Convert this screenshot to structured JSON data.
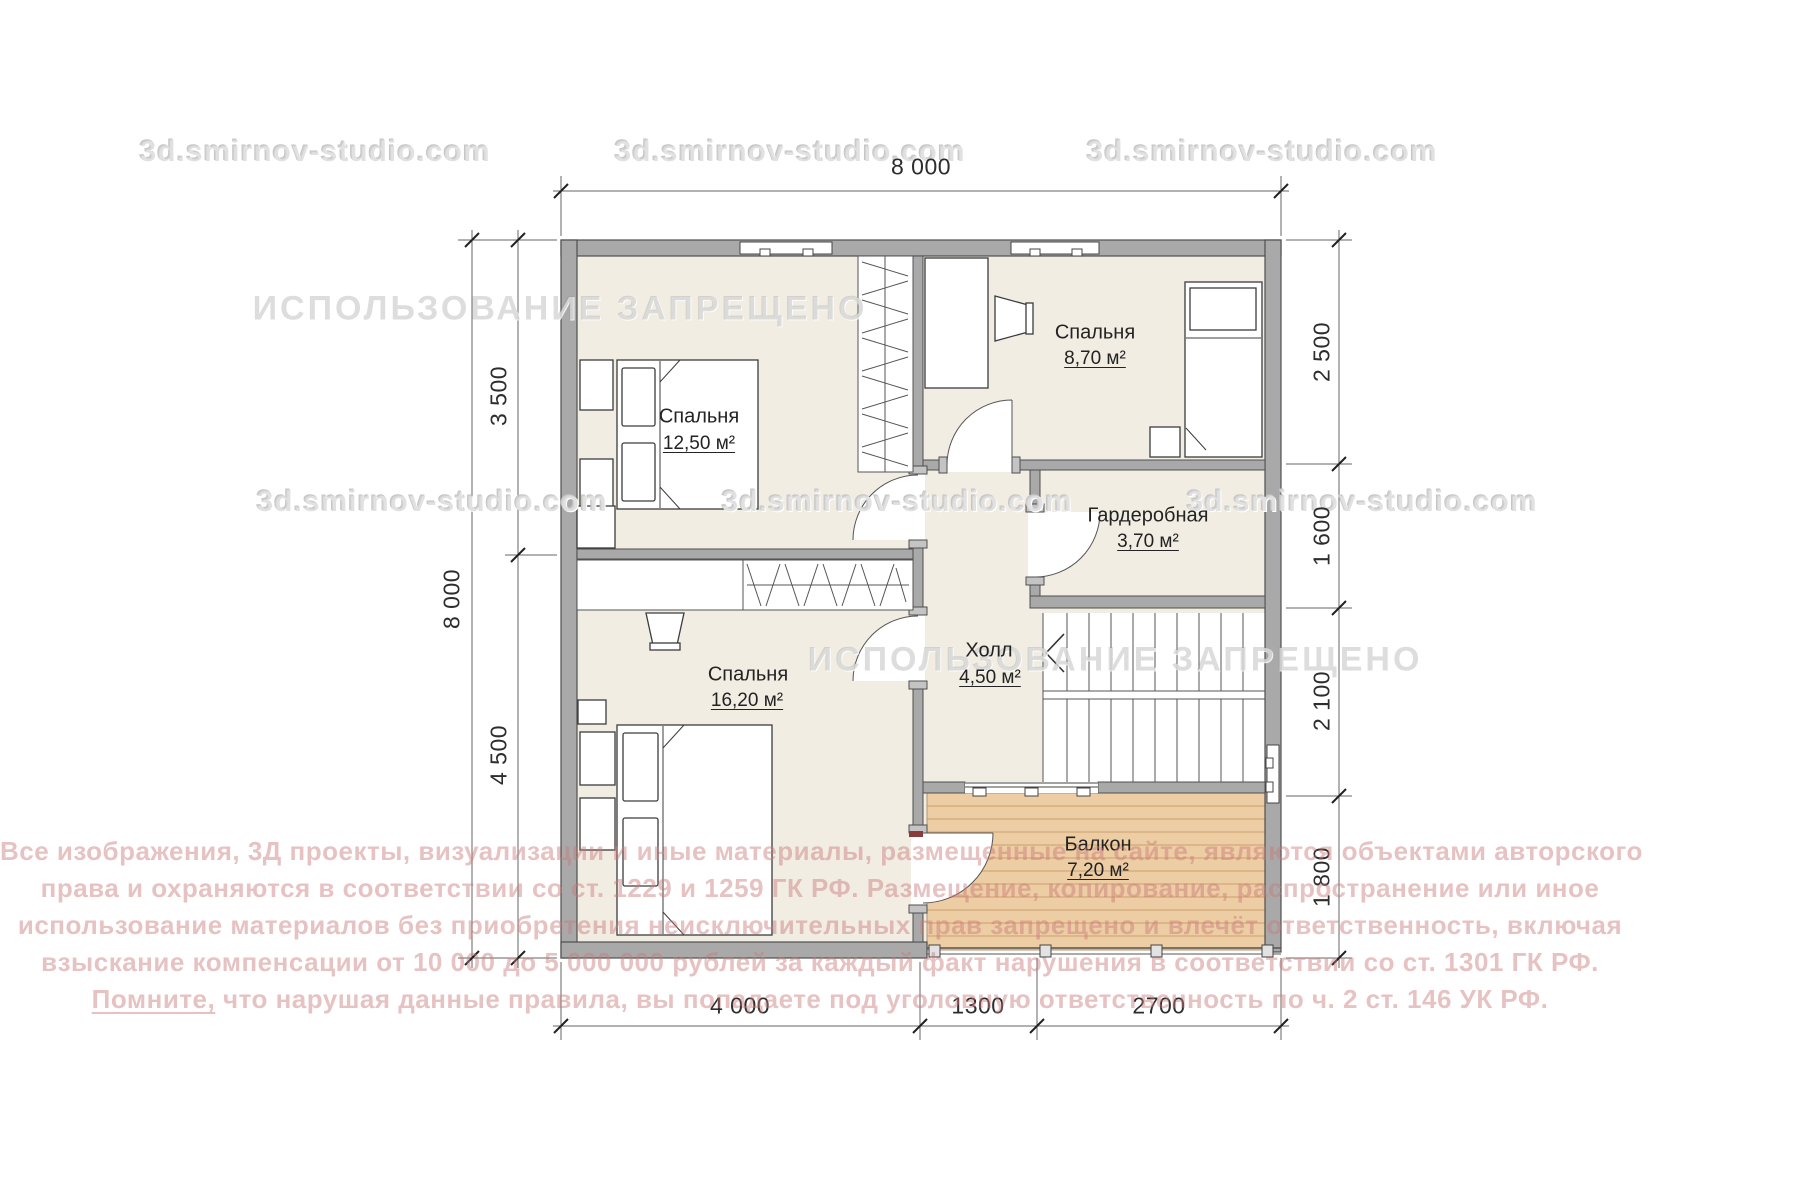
{
  "watermarks": {
    "site_label": "3d.smirnov-studio.com",
    "forbidden_label": "ИСПОЛЬЗОВАНИЕ ЗАПРЕЩЕНО"
  },
  "rooms": [
    {
      "id": "bedroom-1",
      "name": "Спальня",
      "area": "12,50 м²"
    },
    {
      "id": "bedroom-2",
      "name": "Спальня",
      "area": "8,70 м²"
    },
    {
      "id": "wardrobe",
      "name": "Гардеробная",
      "area": "3,70 м²"
    },
    {
      "id": "hall",
      "name": "Холл",
      "area": "4,50 м²"
    },
    {
      "id": "bedroom-3",
      "name": "Спальня",
      "area": "16,20 м²"
    },
    {
      "id": "balcony",
      "name": "Балкон",
      "area": "7,20 м²"
    }
  ],
  "dimensions": {
    "top": [
      "8 000"
    ],
    "left": [
      "8 000",
      "3 500",
      "4 500"
    ],
    "right": [
      "2 500",
      "1 600",
      "2 100",
      "1 800"
    ],
    "bottom": [
      "4 000",
      "1300",
      "2700"
    ]
  },
  "copyright": {
    "line1": "Все изображения, 3Д проекты, визуализации и иные материалы, размещенные на сайте, являются объектами авторского",
    "line2": "права и охраняются в соответствии со ст. 1229 и 1259 ГК РФ. Размещение, копирование, распространение или иное",
    "line3": "использование материалов без приобретения неисключительных прав запрещено и влечёт ответственность, включая",
    "line4": "взыскание компенсации от 10 000 до 5 000 000 рублей за каждый факт нарушения в соответствии со ст. 1301 ГК РФ.",
    "line5_emphasis": "Помните,",
    "line5_rest": " что нарушая данные правила, вы попадаете под уголовную ответственность по ч. 2 ст. 146 УК РФ."
  }
}
